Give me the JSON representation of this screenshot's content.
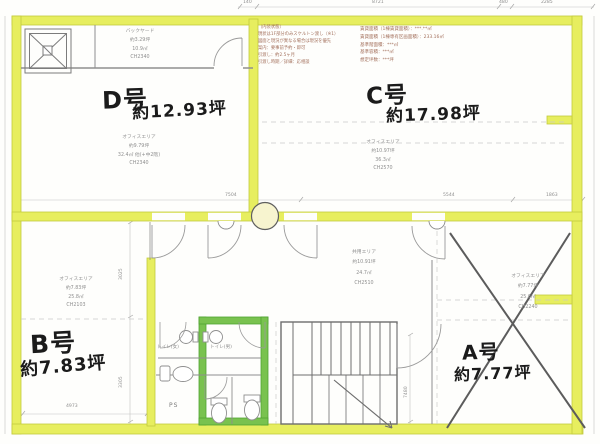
{
  "units": {
    "d": {
      "label": "D号",
      "area": "約12.93坪",
      "info": [
        "オフィスエリア",
        "約9.79坪",
        "32.4㎡ 他(+中2階)",
        "CH2340"
      ]
    },
    "c": {
      "label": "C号",
      "area": "約17.98坪",
      "info": [
        "オフィスエリア",
        "約10.97坪",
        "36.3㎡",
        "CH2570"
      ]
    },
    "b": {
      "label": "B号",
      "area": "約7.83坪",
      "info": [
        "オフィスエリア",
        "約7.83坪",
        "25.8㎡",
        "CH2103"
      ]
    },
    "a": {
      "label": "A号",
      "area": "約7.77坪",
      "status": "crossed-out",
      "info": [
        "オフィスエリア",
        "約7.77坪",
        "25.6㎡",
        "CH2240"
      ]
    }
  },
  "rooms": {
    "backyard": {
      "info": [
        "バックヤード",
        "約3.29坪",
        "10.9㎡",
        "CH2340"
      ]
    },
    "common": {
      "info": [
        "共用エリア",
        "約10.91坪",
        "24.7㎡",
        "CH2510"
      ]
    },
    "toilet_women": "トイレ(女)",
    "toilet_men": "トイレ(男)",
    "pipe_space": "PS"
  },
  "notes": {
    "interior": [
      "（内装状態）",
      "現状は1F部分のみスケルトン渡し（※1）",
      "図面と現況が異なる場合は現況を優先",
      "案内：要事前予約・即可",
      "引渡し：約2.5ヶ月",
      "引渡し時期／詳細：応相談"
    ],
    "area_summary": [
      "賃貸面積（1棟賃貸面積）：***.**㎡",
      "賃貸面積（1棟専有区画面積）：233.16㎡",
      "基準階面積：***㎡",
      "基準容積：***㎡",
      "想定坪数：***坪"
    ]
  },
  "dimensions": {
    "top": [
      "140",
      "8721",
      "480",
      "2285"
    ],
    "middle": [
      "7504",
      "5544",
      "1863"
    ],
    "b_width": "4973",
    "b_height_upper": "3025",
    "b_height_lower": "3305",
    "stair_height": "7480"
  },
  "colors": {
    "highlighter": "#e7ee5f",
    "green_wall": "#79c24f",
    "ink": "#1b1b1b",
    "print": "#8f8f8f",
    "note_text": "#a3705c"
  }
}
